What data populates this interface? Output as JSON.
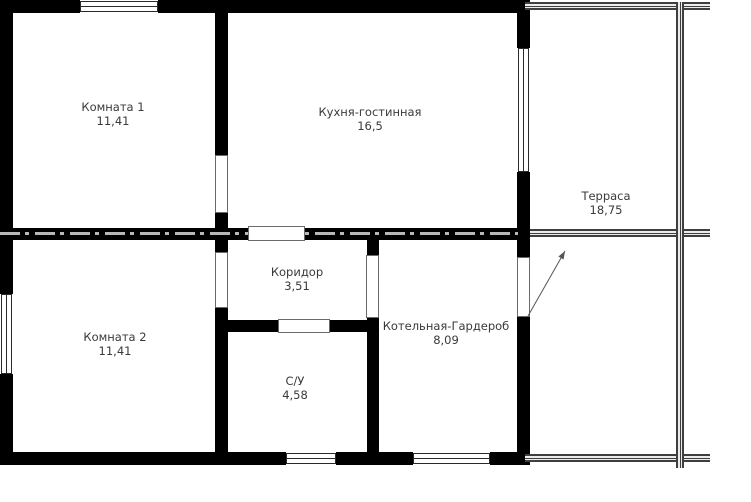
{
  "plan": {
    "rooms": [
      {
        "name": "Комната 1",
        "area": "11,41"
      },
      {
        "name": "Кухня-гостинная",
        "area": "16,5"
      },
      {
        "name": "Терраса",
        "area": "18,75"
      },
      {
        "name": "Комната 2",
        "area": "11,41"
      },
      {
        "name": "Коридор",
        "area": "3,51"
      },
      {
        "name": "С/У",
        "area": "4,58"
      },
      {
        "name": "Котельная-Гардероб",
        "area": "8,09"
      }
    ],
    "colors": {
      "wall": "#000000",
      "background": "#ffffff",
      "text": "#3a3a3a",
      "railing": "#3f3f3f"
    }
  }
}
